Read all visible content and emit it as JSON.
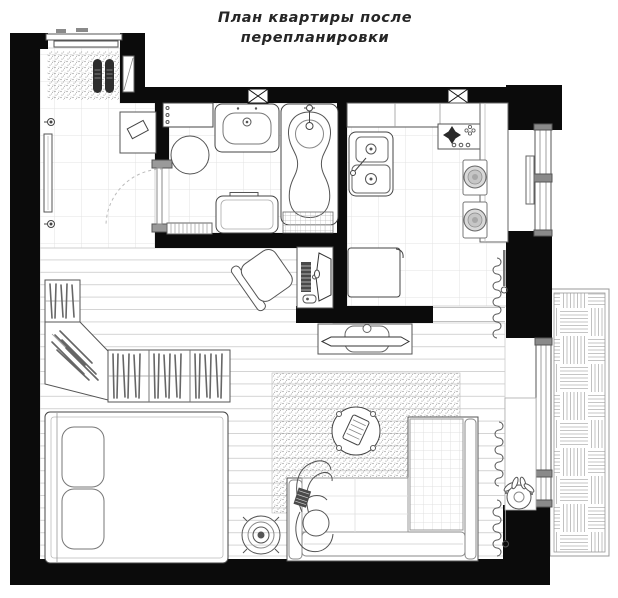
{
  "title": {
    "line1": "План квартиры после",
    "line2": "перепланировки"
  },
  "colors": {
    "walls": "#0b0b0b",
    "outline": "#555555",
    "floor_lines": "#d4d4d4",
    "tile_lines": "#e3e3e3",
    "stipple": "#8a8a8a",
    "background": "#ffffff"
  },
  "floor_plan": {
    "type": "floor-plan",
    "rooms": [
      {
        "id": "entry-hall",
        "furniture": [
          "sliding-entry-door",
          "doormat",
          "shoes",
          "wall-mirror",
          "wall-sconce-upper",
          "wall-sconce-lower",
          "console-table",
          "shoe-cabinet",
          "bathroom-door-swing"
        ]
      },
      {
        "id": "bathroom",
        "furniture": [
          "wall-shelf",
          "washbasin",
          "bathtub",
          "laundry-basket",
          "washing-machine",
          "bath-mat",
          "duckboard-mat",
          "vent-grille"
        ]
      },
      {
        "id": "kitchen",
        "furniture": [
          "counter",
          "cooktop",
          "double-sink",
          "refrigerator",
          "bar-counter",
          "bar-stool-1",
          "bar-stool-2",
          "radiator",
          "window",
          "vent-grille"
        ]
      },
      {
        "id": "workspace",
        "furniture": [
          "desk",
          "monitor",
          "keyboard",
          "mouse",
          "office-chair"
        ]
      },
      {
        "id": "living-area",
        "furniture": [
          "tv-console",
          "tv",
          "corner-sofa",
          "person-on-sofa",
          "coffee-table",
          "serving-tray",
          "floor-lamp",
          "rug",
          "curtains",
          "windowsill",
          "potted-plant",
          "balcony-door"
        ]
      },
      {
        "id": "sleeping-area",
        "furniture": [
          "double-bed",
          "pillow-1",
          "pillow-2",
          "corner-wardrobe"
        ]
      },
      {
        "id": "balcony",
        "furniture": [
          "deck-flooring"
        ]
      }
    ]
  }
}
